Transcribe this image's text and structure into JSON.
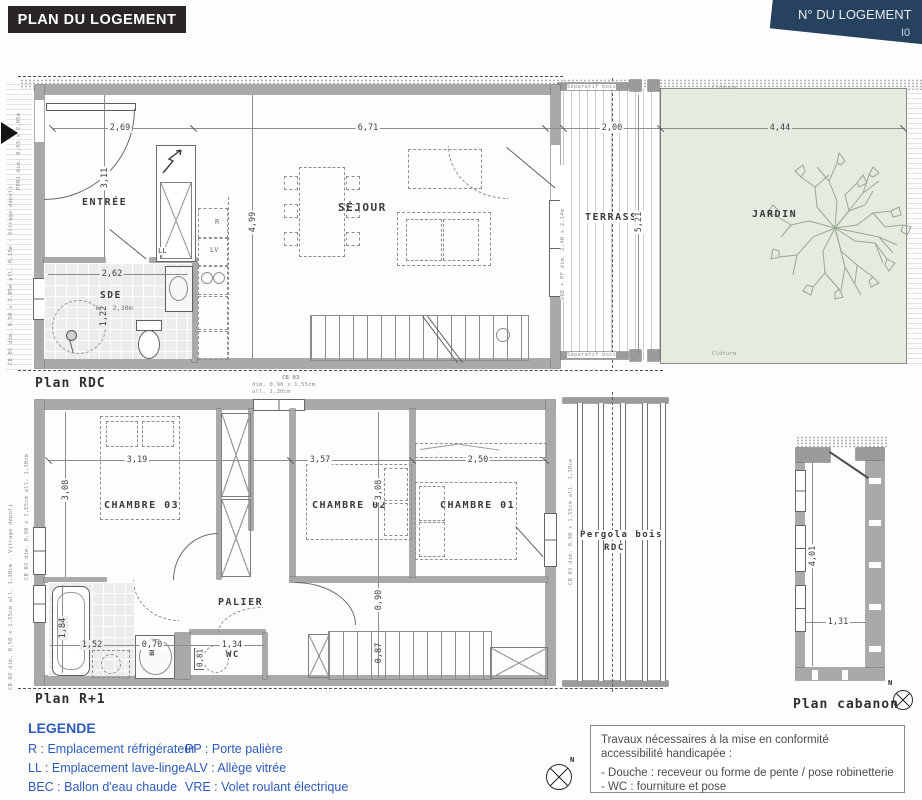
{
  "header": {
    "title": "PLAN DU LOGEMENT",
    "unit_label": "N° DU LOGEMENT",
    "unit_number": "I0"
  },
  "colors": {
    "header_bg": "#2a2526",
    "unit_banner_bg": "#27425f",
    "legend_blue": "#2d5cb8",
    "garden_green": "#e5ebe1",
    "wall_gray": "#a9a9a9"
  },
  "rdc": {
    "caption": "Plan RDC",
    "rooms": {
      "entree": "ENTRÉE",
      "sde": "SDE",
      "sde_height": "HSP 2,30m",
      "sejour": "SÉJOUR",
      "terrasse": "TERRASSE",
      "jardin": "JARDIN"
    },
    "appliances": {
      "ll": "LL",
      "fridge": "R",
      "lv": "LV"
    },
    "dims": {
      "entree_width": "2,69",
      "sejour_width": "6,71",
      "terrasse_width": "2,00",
      "jardin_width": "4,44",
      "entree_depth": "3,11",
      "sejour_depth": "4,99",
      "sde_width": "2,62",
      "sde_depth": "1,22",
      "terrasse_depth": "5,21"
    },
    "site_labels": {
      "separatif_top": "Séparatif bois",
      "separatif_bottom": "Séparatif bois",
      "cloture_top": "Clôture",
      "cloture_bottom": "Clôture"
    },
    "annotations": {
      "entry_door": "PP01 dim. 0,93 x 2,05m",
      "sde_window": "CB 01 dim. 0,50 x 2,05m all. 0,15m - Vitrage dépoli",
      "bay_window": "VRE + PF dim. 2,40 x 2,14m"
    }
  },
  "r1": {
    "caption": "Plan R+1",
    "window_note": {
      "ref": "CB 03",
      "dim": "dim. 0,90 x 1,55cm",
      "all": "all. 1,30cm"
    },
    "rooms": {
      "chambre03": "CHAMBRE 03",
      "chambre02": "CHAMBRE 02",
      "chambre01": "CHAMBRE 01",
      "palier": "PALIER",
      "sde2": "SDE 2",
      "wc": "WC",
      "bec": "BEC"
    },
    "pergola": {
      "line1": "Pergola bois",
      "line2": "RDC"
    },
    "dims": {
      "chambre03_width": "3,19",
      "chambre03_depth": "3,08",
      "chambre02_width": "3,57",
      "chambre02_depth": "3,08",
      "chambre01_width": "2,50",
      "sde2_depth": "1,84",
      "sde2_width": "1,52",
      "bec_width": "0,70",
      "wc_width": "1,34",
      "wc_depth": "0,81",
      "palier_width": "0,90",
      "stair_width": "0,87"
    },
    "annotations": {
      "left_window_top": "CB 03 dim. 0,90 x 1,55cm all. 1,30cm",
      "left_window_bottom": "CB 02 dim. 0,50 x 1,55cm all. 1,30cm - Vitrage dépoli",
      "right_window": "CB 03 dim. 0,90 x 1,55cm all. 1,30cm"
    }
  },
  "cabanon": {
    "caption": "Plan cabanon",
    "dims": {
      "depth": "4,01",
      "width": "1,31"
    },
    "compass": "N"
  },
  "legend": {
    "title": "LEGENDE",
    "col1": [
      "R : Emplacement réfrigérateur",
      "LL : Emplacement lave-linge",
      "BEC : Ballon d'eau chaude"
    ],
    "col2": [
      "PP : Porte palière",
      "ALV : Allège vitrée",
      "VRE : Volet roulant électrique"
    ],
    "compass": "N"
  },
  "note_box": {
    "lines": [
      "Travaux nécessaires à la mise en conformité",
      "accessibilité handicapée :",
      "- Douche : receveur ou forme de pente / pose robinetterie",
      "- WC : fourniture et pose"
    ]
  }
}
